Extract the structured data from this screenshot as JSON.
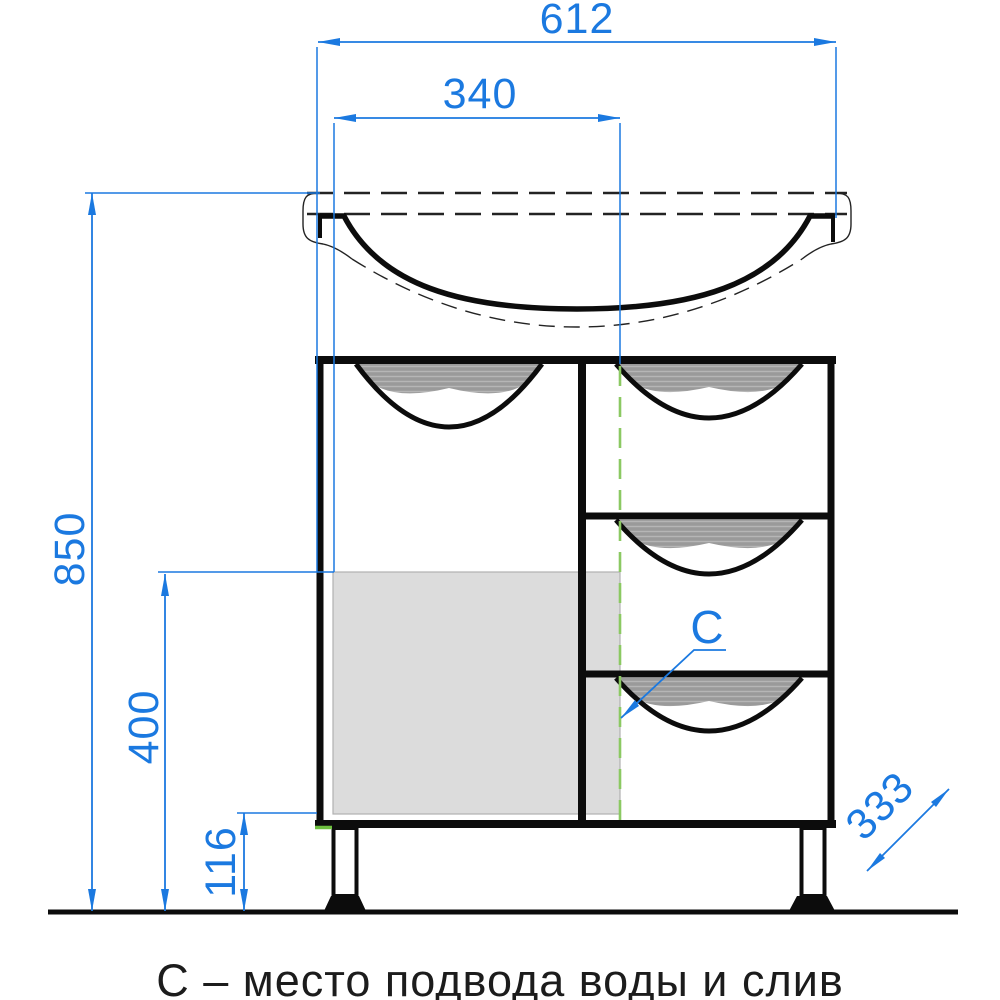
{
  "drawing": {
    "caption": "С – место подвода воды и слив",
    "dims": {
      "sink_width": "612",
      "drain_offset": "340",
      "total_height": "850",
      "service_zone_height": "400",
      "plinth_height": "116",
      "depth": "333"
    },
    "labels": {
      "connection_point": "С"
    },
    "colors": {
      "dimension_blue": "#1b79e0",
      "axis_green": "#8bc962",
      "corner_tick_green": "#6dbf3f",
      "handle_gray": "#9a9a9a",
      "panel_gray": "#dadada",
      "line_black": "#141414"
    }
  }
}
